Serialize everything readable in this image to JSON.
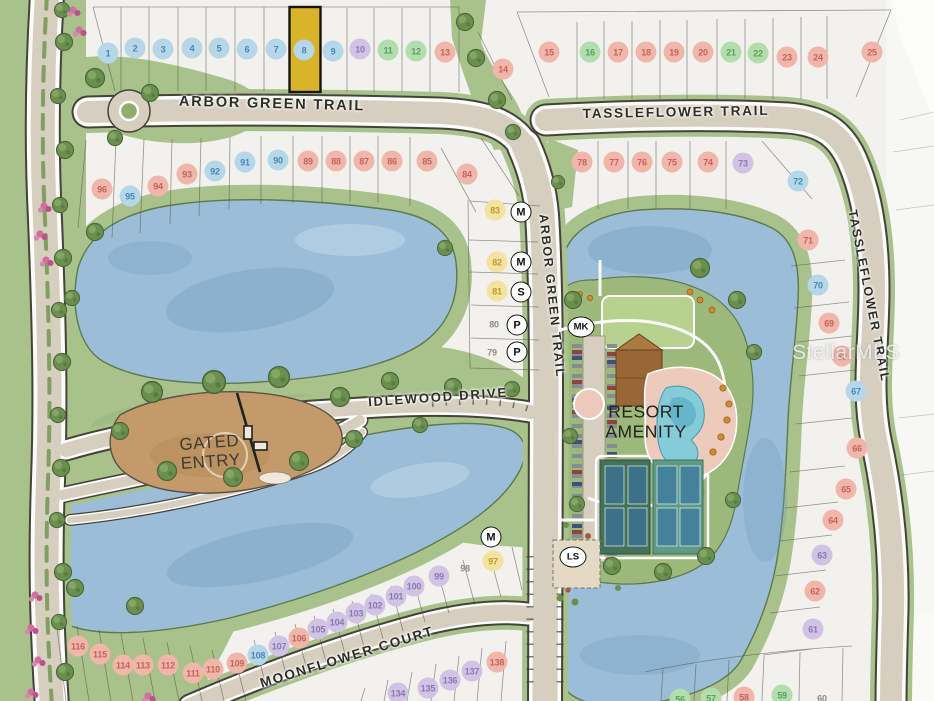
{
  "map": {
    "highlighted_lot": "8",
    "highlight_fill": "#d9b32a",
    "watermark": "StellarMLS",
    "streets": {
      "arbor_green_trail_h": "ARBOR GREEN TRAIL",
      "arbor_green_trail_v": "ARBOR GREEN TRAIL",
      "tassleflower_trail_h": "TASSLEFLOWER TRAIL",
      "tassleflower_trail_v": "TASSLEFLOWER TRAIL",
      "idlewood_drive": "IDLEWOOD DRIVE",
      "moonflower_court": "MOONFLOWER COURT"
    },
    "labels": {
      "gated_entry_line1": "GATED",
      "gated_entry_line2": "ENTRY",
      "resort_amenity_line1": "RESORT",
      "resort_amenity_line2": "AMENITY"
    },
    "legend_colors": {
      "blue": {
        "bg": "#b5d7e8",
        "text": "#4b87ba"
      },
      "red": {
        "bg": "#f1b6aa",
        "text": "#c2655c"
      },
      "green": {
        "bg": "#b4ddae",
        "text": "#58a15c"
      },
      "purple": {
        "bg": "#d0c3e4",
        "text": "#8a79b4"
      },
      "yellow": {
        "bg": "#f3e2a0",
        "text": "#c19a2e"
      },
      "plain": {
        "bg": "transparent",
        "text": "#8d8d85"
      }
    },
    "lots": [
      {
        "n": "1",
        "x": 108,
        "y": 53,
        "c": "blue"
      },
      {
        "n": "2",
        "x": 135,
        "y": 48,
        "c": "blue"
      },
      {
        "n": "3",
        "x": 163,
        "y": 49,
        "c": "blue"
      },
      {
        "n": "4",
        "x": 192,
        "y": 48,
        "c": "blue"
      },
      {
        "n": "5",
        "x": 219,
        "y": 48,
        "c": "blue"
      },
      {
        "n": "6",
        "x": 247,
        "y": 49,
        "c": "blue"
      },
      {
        "n": "7",
        "x": 276,
        "y": 49,
        "c": "blue"
      },
      {
        "n": "8",
        "x": 304,
        "y": 50,
        "c": "blue"
      },
      {
        "n": "9",
        "x": 333,
        "y": 51,
        "c": "blue"
      },
      {
        "n": "10",
        "x": 360,
        "y": 49,
        "c": "purple"
      },
      {
        "n": "11",
        "x": 388,
        "y": 50,
        "c": "green"
      },
      {
        "n": "12",
        "x": 416,
        "y": 51,
        "c": "green"
      },
      {
        "n": "13",
        "x": 445,
        "y": 52,
        "c": "red"
      },
      {
        "n": "14",
        "x": 503,
        "y": 69,
        "c": "red"
      },
      {
        "n": "15",
        "x": 549,
        "y": 52,
        "c": "red"
      },
      {
        "n": "16",
        "x": 590,
        "y": 52,
        "c": "green"
      },
      {
        "n": "17",
        "x": 618,
        "y": 52,
        "c": "red"
      },
      {
        "n": "18",
        "x": 646,
        "y": 52,
        "c": "red"
      },
      {
        "n": "19",
        "x": 674,
        "y": 52,
        "c": "red"
      },
      {
        "n": "20",
        "x": 703,
        "y": 52,
        "c": "red"
      },
      {
        "n": "21",
        "x": 731,
        "y": 52,
        "c": "green"
      },
      {
        "n": "22",
        "x": 758,
        "y": 53,
        "c": "green"
      },
      {
        "n": "23",
        "x": 787,
        "y": 57,
        "c": "red"
      },
      {
        "n": "24",
        "x": 818,
        "y": 57,
        "c": "red"
      },
      {
        "n": "25",
        "x": 872,
        "y": 52,
        "c": "red"
      },
      {
        "n": "96",
        "x": 102,
        "y": 189,
        "c": "red"
      },
      {
        "n": "95",
        "x": 130,
        "y": 196,
        "c": "blue"
      },
      {
        "n": "94",
        "x": 158,
        "y": 186,
        "c": "red"
      },
      {
        "n": "93",
        "x": 187,
        "y": 174,
        "c": "red"
      },
      {
        "n": "92",
        "x": 215,
        "y": 171,
        "c": "blue"
      },
      {
        "n": "91",
        "x": 245,
        "y": 162,
        "c": "blue"
      },
      {
        "n": "90",
        "x": 278,
        "y": 160,
        "c": "blue"
      },
      {
        "n": "89",
        "x": 308,
        "y": 161,
        "c": "red"
      },
      {
        "n": "88",
        "x": 336,
        "y": 161,
        "c": "red"
      },
      {
        "n": "87",
        "x": 364,
        "y": 161,
        "c": "red"
      },
      {
        "n": "86",
        "x": 392,
        "y": 161,
        "c": "red"
      },
      {
        "n": "85",
        "x": 427,
        "y": 161,
        "c": "red"
      },
      {
        "n": "84",
        "x": 467,
        "y": 174,
        "c": "red"
      },
      {
        "n": "83",
        "x": 495,
        "y": 210,
        "c": "yellow"
      },
      {
        "n": "82",
        "x": 497,
        "y": 262,
        "c": "yellow"
      },
      {
        "n": "81",
        "x": 497,
        "y": 291,
        "c": "yellow"
      },
      {
        "n": "80",
        "x": 494,
        "y": 324,
        "c": "plain"
      },
      {
        "n": "79",
        "x": 492,
        "y": 352,
        "c": "plain"
      },
      {
        "n": "78",
        "x": 582,
        "y": 162,
        "c": "red"
      },
      {
        "n": "77",
        "x": 614,
        "y": 162,
        "c": "red"
      },
      {
        "n": "76",
        "x": 642,
        "y": 162,
        "c": "red"
      },
      {
        "n": "75",
        "x": 672,
        "y": 162,
        "c": "red"
      },
      {
        "n": "74",
        "x": 708,
        "y": 162,
        "c": "red"
      },
      {
        "n": "73",
        "x": 743,
        "y": 163,
        "c": "purple"
      },
      {
        "n": "72",
        "x": 798,
        "y": 181,
        "c": "blue"
      },
      {
        "n": "71",
        "x": 808,
        "y": 240,
        "c": "red"
      },
      {
        "n": "70",
        "x": 818,
        "y": 285,
        "c": "blue"
      },
      {
        "n": "69",
        "x": 829,
        "y": 323,
        "c": "red"
      },
      {
        "n": "68",
        "x": 842,
        "y": 356,
        "c": "red"
      },
      {
        "n": "67",
        "x": 856,
        "y": 391,
        "c": "blue"
      },
      {
        "n": "66",
        "x": 857,
        "y": 448,
        "c": "red"
      },
      {
        "n": "65",
        "x": 846,
        "y": 489,
        "c": "red"
      },
      {
        "n": "64",
        "x": 833,
        "y": 520,
        "c": "red"
      },
      {
        "n": "63",
        "x": 822,
        "y": 555,
        "c": "purple"
      },
      {
        "n": "62",
        "x": 815,
        "y": 591,
        "c": "red"
      },
      {
        "n": "61",
        "x": 813,
        "y": 629,
        "c": "purple"
      },
      {
        "n": "56",
        "x": 680,
        "y": 699,
        "c": "green"
      },
      {
        "n": "57",
        "x": 711,
        "y": 698,
        "c": "green"
      },
      {
        "n": "58",
        "x": 744,
        "y": 697,
        "c": "red"
      },
      {
        "n": "59",
        "x": 782,
        "y": 695,
        "c": "green"
      },
      {
        "n": "60",
        "x": 822,
        "y": 698,
        "c": "plain"
      },
      {
        "n": "97",
        "x": 493,
        "y": 561,
        "c": "yellow"
      },
      {
        "n": "98",
        "x": 465,
        "y": 568,
        "c": "plain"
      },
      {
        "n": "99",
        "x": 439,
        "y": 576,
        "c": "purple"
      },
      {
        "n": "100",
        "x": 414,
        "y": 586,
        "c": "purple"
      },
      {
        "n": "101",
        "x": 396,
        "y": 596,
        "c": "purple"
      },
      {
        "n": "102",
        "x": 375,
        "y": 605,
        "c": "purple"
      },
      {
        "n": "103",
        "x": 356,
        "y": 613,
        "c": "purple"
      },
      {
        "n": "104",
        "x": 337,
        "y": 622,
        "c": "purple"
      },
      {
        "n": "105",
        "x": 318,
        "y": 629,
        "c": "purple"
      },
      {
        "n": "106",
        "x": 299,
        "y": 638,
        "c": "red"
      },
      {
        "n": "107",
        "x": 279,
        "y": 646,
        "c": "purple"
      },
      {
        "n": "108",
        "x": 258,
        "y": 655,
        "c": "blue"
      },
      {
        "n": "109",
        "x": 237,
        "y": 663,
        "c": "red"
      },
      {
        "n": "110",
        "x": 213,
        "y": 669,
        "c": "red"
      },
      {
        "n": "111",
        "x": 193,
        "y": 673,
        "c": "red"
      },
      {
        "n": "112",
        "x": 168,
        "y": 665,
        "c": "red"
      },
      {
        "n": "113",
        "x": 143,
        "y": 665,
        "c": "red"
      },
      {
        "n": "114",
        "x": 123,
        "y": 665,
        "c": "red"
      },
      {
        "n": "115",
        "x": 100,
        "y": 654,
        "c": "red"
      },
      {
        "n": "116",
        "x": 78,
        "y": 646,
        "c": "red"
      },
      {
        "n": "134",
        "x": 398,
        "y": 693,
        "c": "purple"
      },
      {
        "n": "135",
        "x": 428,
        "y": 688,
        "c": "purple"
      },
      {
        "n": "136",
        "x": 450,
        "y": 680,
        "c": "purple"
      },
      {
        "n": "137",
        "x": 472,
        "y": 671,
        "c": "purple"
      },
      {
        "n": "138",
        "x": 497,
        "y": 662,
        "c": "red"
      }
    ],
    "badges": [
      {
        "label": "M",
        "x": 521,
        "y": 212,
        "wide": false
      },
      {
        "label": "M",
        "x": 521,
        "y": 262,
        "wide": false
      },
      {
        "label": "S",
        "x": 521,
        "y": 292,
        "wide": false
      },
      {
        "label": "P",
        "x": 517,
        "y": 325,
        "wide": false
      },
      {
        "label": "P",
        "x": 517,
        "y": 352,
        "wide": false
      },
      {
        "label": "M",
        "x": 491,
        "y": 537,
        "wide": false
      },
      {
        "label": "MK",
        "x": 581,
        "y": 327,
        "wide": true
      },
      {
        "label": "LS",
        "x": 573,
        "y": 557,
        "wide": true
      }
    ]
  }
}
